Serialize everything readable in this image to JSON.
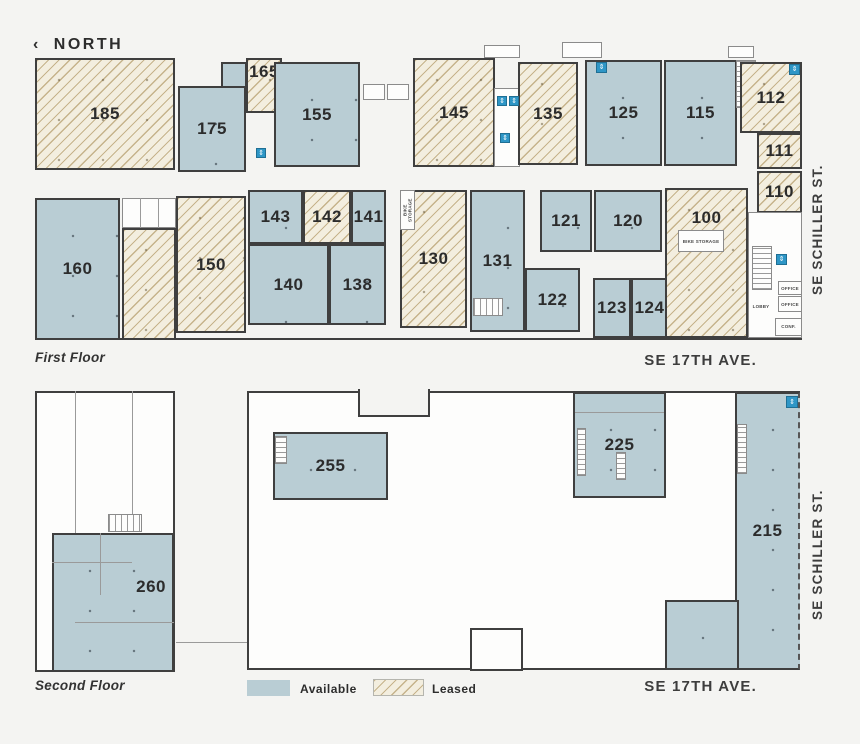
{
  "north": {
    "chevron": "‹",
    "label": "NORTH"
  },
  "captions": {
    "first": "First Floor",
    "second": "Second Floor"
  },
  "streets": {
    "schiller": "SE SCHILLER ST.",
    "seventeenth": "SE 17TH AVE."
  },
  "legend": {
    "available": "Available",
    "leased": "Leased"
  },
  "colors": {
    "available_fill": "#b9cdd4",
    "leased_fill": "#f3eedf",
    "leased_stripe": "#baa476",
    "wall": "#3f3f3f",
    "background": "#f4f4f2",
    "icon_blue": "#2e96c6",
    "text": "#2d2d2d"
  },
  "rooms": {
    "bike_storage_a": "BIKE STORAGE",
    "bike_storage_b": "BIKE STORAGE",
    "lobby": "LOBBY",
    "office_a": "OFFICE",
    "office_b": "OFFICE",
    "conference": "CONF."
  },
  "icons": {
    "elevator": "⇕",
    "restroom": "⇕"
  },
  "floors": {
    "first": {
      "units": [
        {
          "number": "185",
          "status": "leased"
        },
        {
          "number": "175",
          "status": "available"
        },
        {
          "number": "165",
          "status": "leased"
        },
        {
          "number": "155",
          "status": "available"
        },
        {
          "number": "145",
          "status": "leased"
        },
        {
          "number": "135",
          "status": "leased"
        },
        {
          "number": "125",
          "status": "available"
        },
        {
          "number": "115",
          "status": "available"
        },
        {
          "number": "112",
          "status": "leased"
        },
        {
          "number": "111",
          "status": "leased"
        },
        {
          "number": "110",
          "status": "leased"
        },
        {
          "number": "160",
          "status": "available"
        },
        {
          "number": "150",
          "status": "leased"
        },
        {
          "number": "143",
          "status": "available"
        },
        {
          "number": "142",
          "status": "leased"
        },
        {
          "number": "141",
          "status": "available"
        },
        {
          "number": "140",
          "status": "available"
        },
        {
          "number": "138",
          "status": "available"
        },
        {
          "number": "130",
          "status": "leased"
        },
        {
          "number": "131",
          "status": "available"
        },
        {
          "number": "121",
          "status": "available"
        },
        {
          "number": "120",
          "status": "available"
        },
        {
          "number": "122",
          "status": "available"
        },
        {
          "number": "123",
          "status": "available"
        },
        {
          "number": "124",
          "status": "available"
        },
        {
          "number": "100",
          "status": "leased"
        },
        {
          "number": "",
          "status": "leased"
        }
      ]
    },
    "second": {
      "units": [
        {
          "number": "255",
          "status": "available"
        },
        {
          "number": "225",
          "status": "available"
        },
        {
          "number": "215",
          "status": "available"
        },
        {
          "number": "260",
          "status": "available"
        }
      ]
    }
  }
}
